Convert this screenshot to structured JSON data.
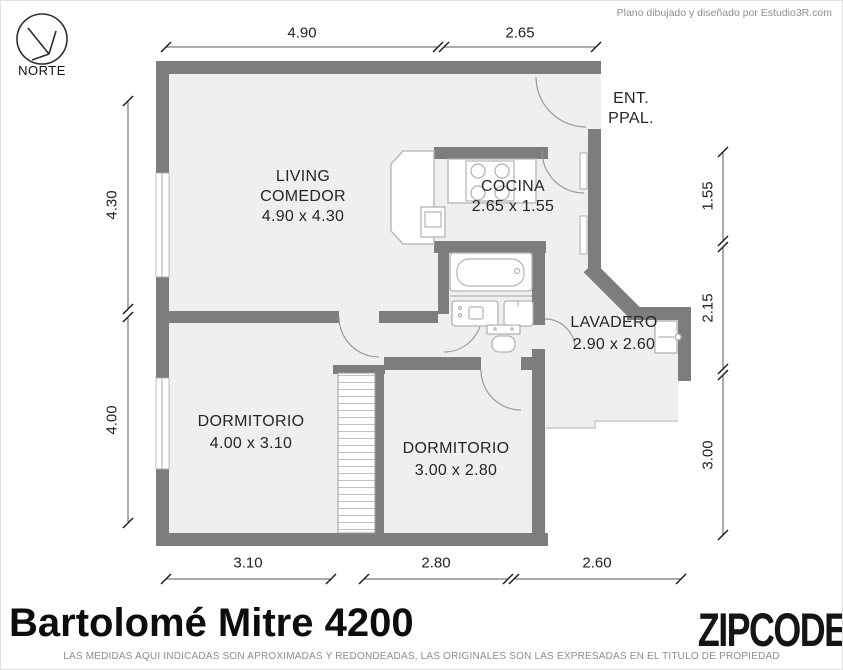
{
  "header": {
    "credit": "Plano dibujado y diseñado por Estudio3R.com"
  },
  "compass": {
    "label": "NORTE"
  },
  "rooms": {
    "living": {
      "line1": "LIVING",
      "line2": "COMEDOR",
      "size": "4.90 x 4.30"
    },
    "cocina": {
      "name": "COCINA",
      "size": "2.65 x 1.55"
    },
    "entrance": {
      "line1": "ENT.",
      "line2": "PPAL."
    },
    "lavadero": {
      "name": "LAVADERO",
      "size": "2.90 x 2.60"
    },
    "dormitorio_1": {
      "name": "DORMITORIO",
      "size": "4.00 x 3.10"
    },
    "dormitorio_2": {
      "name": "DORMITORIO",
      "size": "3.00 x 2.80"
    }
  },
  "dimensions": {
    "top": [
      "4.90",
      "2.65"
    ],
    "bottom": [
      "3.10",
      "2.80",
      "2.60"
    ],
    "left": [
      "4.30",
      "4.00"
    ],
    "right": [
      "1.55",
      "2.15",
      "3.00"
    ]
  },
  "footer": {
    "title": "Bartolomé Mitre 4200",
    "brand": "ZIPCODE",
    "disclaimer": "LAS MEDIDAS AQUI INDICADAS SON APROXIMADAS Y REDONDEADAS, LAS ORIGINALES SON LAS EXPRESADAS EN EL TITULO DE PROPIEDAD"
  },
  "colors": {
    "wall": "#7d7d7d",
    "floor": "#f0efed",
    "dim_text": "#222222"
  }
}
